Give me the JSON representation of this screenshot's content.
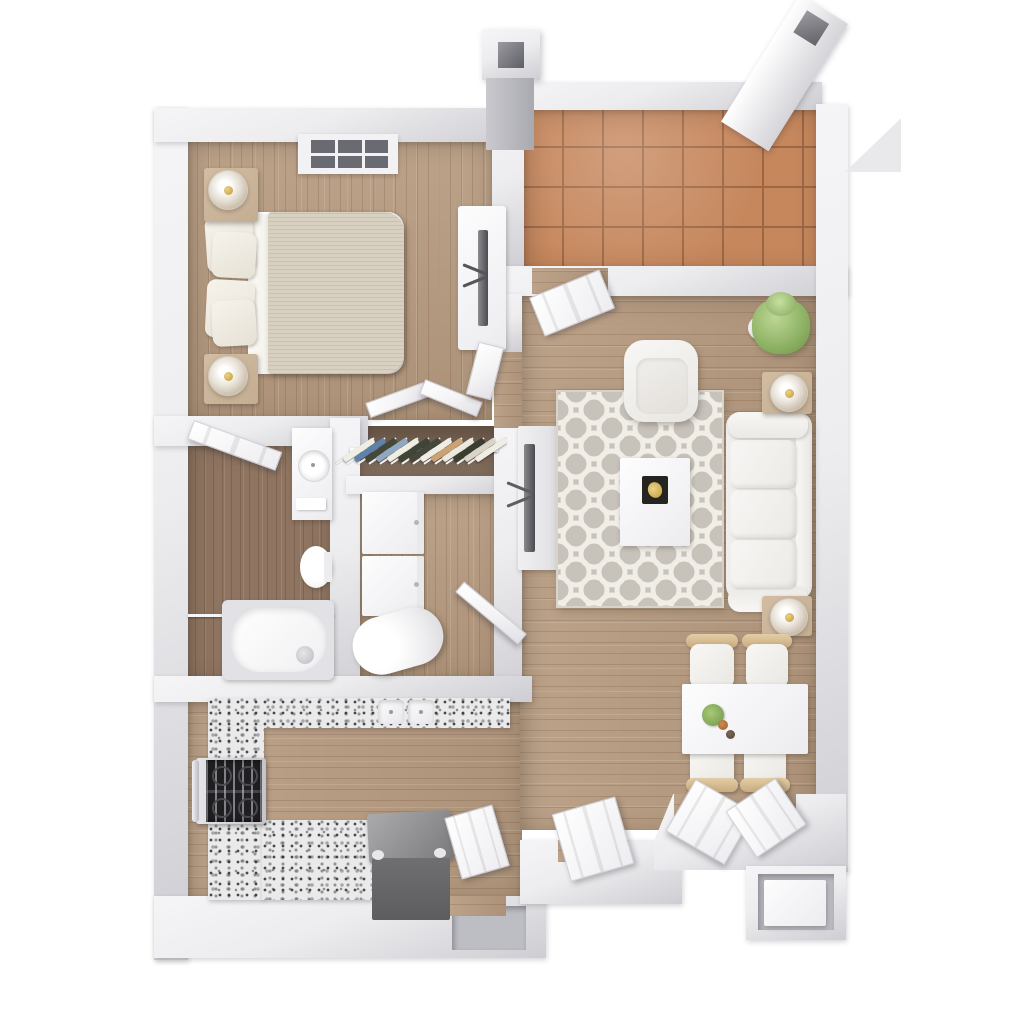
{
  "scene": {
    "title": "3D apartment floor plan, top-down view",
    "background": "#ffffff",
    "style": "photoreal 3D render, one-bedroom unit with patio"
  },
  "palette": {
    "wall_top": "#ededef",
    "wall_side": "#cdcdd3",
    "wall_dark": "#bdbdc4",
    "floor_wood": "#b79b80",
    "bath_wood": "#8f7561",
    "closet_wood": "#776250",
    "tile": "#c6875d",
    "tile_grout": "#9c6844",
    "granite": "#eaeaea",
    "rug_base": "#c7c2ba",
    "rug_pattern": "#f1eee8",
    "door_white": "#fbfbfc",
    "sofa_white": "#f2f1ef",
    "duvet": "#d8d1c2",
    "wood_furniture": "#c4ad92",
    "gold": "#c09a3e",
    "plant": "#8cb163",
    "tv_dark": "#55555a",
    "trash": "#6f6f72",
    "stove": "#1f1f22"
  },
  "rooms": [
    {
      "name": "bedroom",
      "items": [
        "skylight-window",
        "bed-with-duvet",
        "four-pillows",
        "nightstand-top",
        "nightstand-bottom",
        "two-table-lamps",
        "dresser",
        "tv-on-dresser"
      ]
    },
    {
      "name": "closet",
      "items": [
        "bifold-doors",
        "hanging-rod",
        "hanging-clothes"
      ]
    },
    {
      "name": "bathroom",
      "items": [
        "swing-door",
        "vanity-with-round-sink",
        "toilet",
        "bathtub",
        "shower-rod",
        "tub-faucet",
        "towel"
      ]
    },
    {
      "name": "laundry-closet",
      "items": [
        "stacked-washer",
        "stacked-dryer",
        "water-heater",
        "swing-door"
      ]
    },
    {
      "name": "kitchen",
      "items": [
        "granite-counter-top-run",
        "granite-counter-left-run",
        "granite-counter-bottom-run",
        "double-basin-sink",
        "gas-range",
        "trash-bin"
      ]
    },
    {
      "name": "living-room",
      "items": [
        "tv-console",
        "flat-screen-tv",
        "quatrefoil-area-rug",
        "armchair",
        "coffee-table",
        "decor-tray",
        "three-seat-sofa",
        "end-table-top",
        "end-table-bottom",
        "two-glass-lamps",
        "potted-plant",
        "patio-door"
      ]
    },
    {
      "name": "dining-area",
      "items": [
        "white-dining-table",
        "four-chairs",
        "centerpiece-bowl",
        "small-decor"
      ]
    },
    {
      "name": "patio",
      "items": [
        "terracotta-tile-floor",
        "chimney-column-left",
        "chimney-column-right",
        "angled-parapet-wall"
      ]
    },
    {
      "name": "entry",
      "items": [
        "pantry-door",
        "front-door",
        "double-doors",
        "exterior-alcove-storage-box"
      ]
    }
  ],
  "closet": {
    "clothes_colors": [
      "#f0ede4",
      "#5f82a8",
      "#44483a",
      "#8fa7c0",
      "#f0ede4",
      "#3f4536",
      "#44483a",
      "#f0ede4",
      "#caa273",
      "#ece8df",
      "#3a3e31",
      "#d9d4c8",
      "#f0ede4"
    ]
  }
}
